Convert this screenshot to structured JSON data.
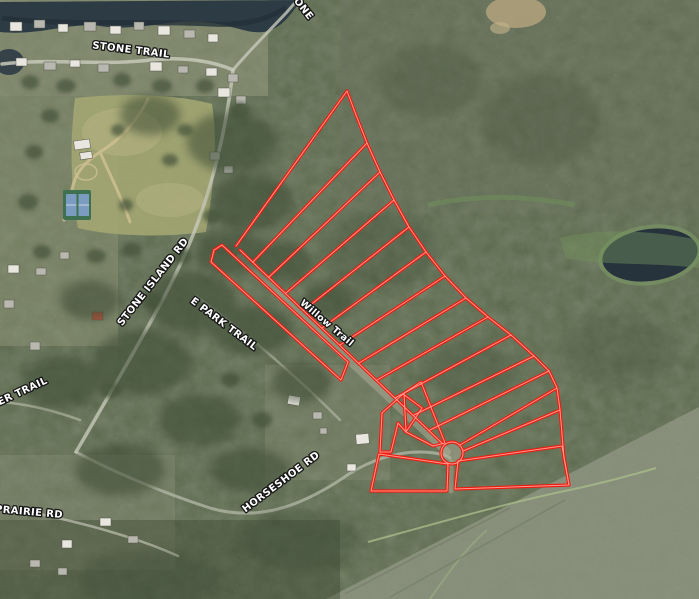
{
  "map": {
    "type": "satellite-parcel-map",
    "description": "Aerial/satellite view with red-outlined subdivision parcels along Willow Trail",
    "road_labels": [
      {
        "id": "stone-trail",
        "text": "STONE TRAIL"
      },
      {
        "id": "stone-trail-top",
        "text": "STONE"
      },
      {
        "id": "stone-island-rd",
        "text": "STONE ISLAND RD"
      },
      {
        "id": "e-park-trail",
        "text": "E PARK TRAIL"
      },
      {
        "id": "willow-trail",
        "text": "Willow Trail"
      },
      {
        "id": "ber-trail",
        "text": "BER TRAIL"
      },
      {
        "id": "prairie-rd",
        "text": "PRAIRIE RD"
      },
      {
        "id": "horseshoe-rd",
        "text": "HORSESHOE RD"
      }
    ],
    "colors": {
      "parcel_outline": "#f2190e",
      "parcel_inner_glow": "#ffab9e",
      "water": "#2d3b45",
      "lake": "#26323c",
      "forest_base": "#5e6b50",
      "field": "#a3a672",
      "marsh": "#8d9480",
      "marsh_green": "#74935d",
      "road": "#c7c9ba",
      "dirt": "#b3a27c",
      "tennis_court": "#7b9cc0",
      "tennis_surround": "#3f7050",
      "label_fill": "#ffffff",
      "label_outline": "#161616"
    },
    "features": {
      "parcel_strips_north_of_willow_trail": 12,
      "fan_lots_at_culdesac": 5,
      "large_bottom_lots": 2,
      "culdesac": true,
      "tennis_courts": 2,
      "lake_right": true,
      "river_top": true
    }
  }
}
